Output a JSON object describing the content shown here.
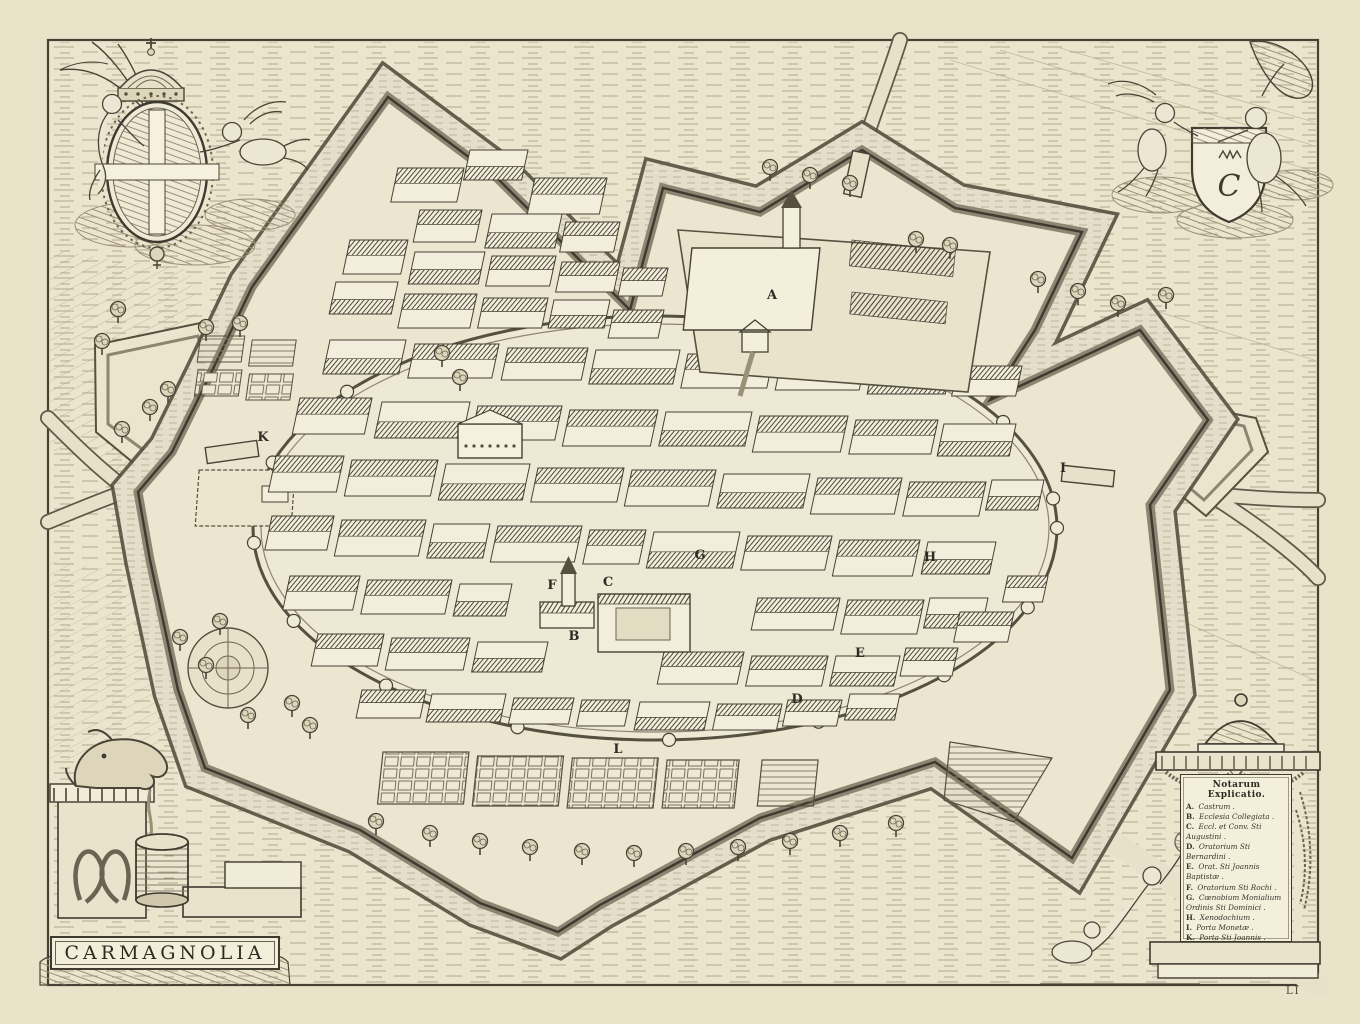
{
  "map": {
    "title": "CARMAGNOLIA",
    "plate_mark": "LI",
    "monogram": "C",
    "legend": {
      "heading": "Notarum Explicatio.",
      "entries": [
        {
          "key": "A.",
          "text": "Castrum ."
        },
        {
          "key": "B.",
          "text": "Ecclesia Collegiata ."
        },
        {
          "key": "C.",
          "text": "Eccl. et Conv. Sti Augustini ."
        },
        {
          "key": "D.",
          "text": "Oratorium Sti Bernardini ."
        },
        {
          "key": "E.",
          "text": "Orat. Sti Joannis Baptistæ ."
        },
        {
          "key": "F.",
          "text": "Oratorium Sti Rochi ."
        },
        {
          "key": "G.",
          "text": "Cœnobium Monialium Ordinis Sti Dominici ."
        },
        {
          "key": "H.",
          "text": "Xenodochium ."
        },
        {
          "key": "I.",
          "text": "Porta Monetæ ."
        },
        {
          "key": "K.",
          "text": "Porta Sti Joannis ."
        },
        {
          "key": "L.",
          "text": "Porta Zuchetæ ."
        }
      ]
    },
    "labels_on_map": [
      {
        "letter": "A",
        "x": 772,
        "y": 299
      },
      {
        "letter": "B",
        "x": 574,
        "y": 640
      },
      {
        "letter": "C",
        "x": 608,
        "y": 586
      },
      {
        "letter": "D",
        "x": 797,
        "y": 703
      },
      {
        "letter": "E",
        "x": 860,
        "y": 657
      },
      {
        "letter": "F",
        "x": 552,
        "y": 589
      },
      {
        "letter": "G",
        "x": 700,
        "y": 559
      },
      {
        "letter": "H",
        "x": 930,
        "y": 561
      },
      {
        "letter": "I",
        "x": 1063,
        "y": 472
      },
      {
        "letter": "K",
        "x": 263,
        "y": 441
      },
      {
        "letter": "L",
        "x": 618,
        "y": 753
      }
    ],
    "colors": {
      "paper": "#e9e3ca",
      "ink": "#3f3a30",
      "moat": "#e4deca",
      "roof": "#454034"
    }
  }
}
